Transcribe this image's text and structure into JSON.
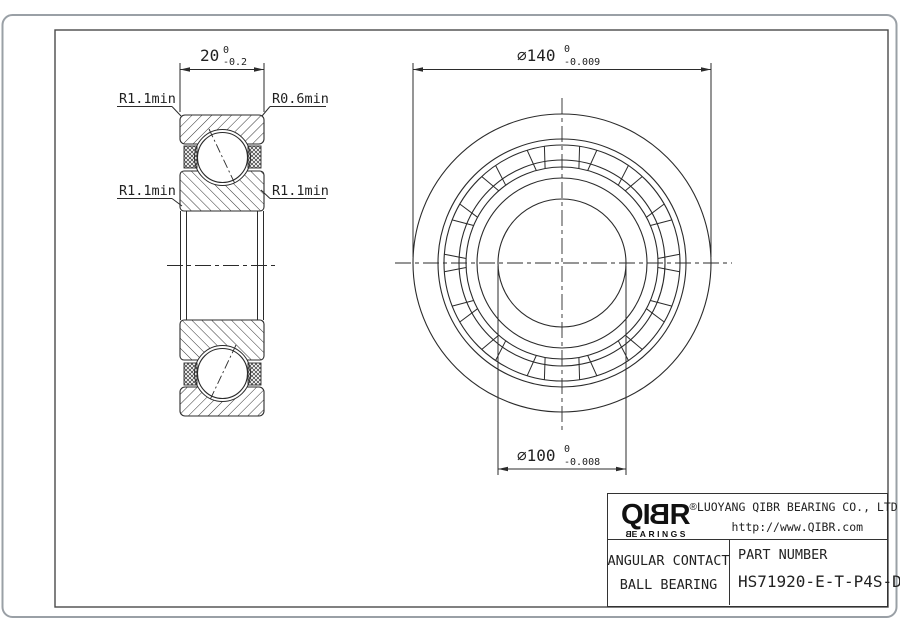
{
  "colors": {
    "line": "#2b2b2b",
    "frame": "#4a4a4a",
    "page_border": "#9aa0a6",
    "title_lines": "#333333"
  },
  "left_view": {
    "width_dim": {
      "value": "20",
      "tol_upper": "0",
      "tol_lower": "-0.2"
    },
    "labels": {
      "top_left": "R1.1min",
      "top_right": "R0.6min",
      "bottom_left": "R1.1min",
      "bottom_right": "R1.1min"
    }
  },
  "front_view": {
    "od_dim": {
      "symbol": "⌀",
      "value": "140",
      "tol_upper": "0",
      "tol_lower": "-0.009"
    },
    "bore_dim": {
      "symbol": "⌀",
      "value": "100",
      "tol_upper": "0",
      "tol_lower": "-0.008"
    }
  },
  "title_block": {
    "logo": {
      "l1": "Q",
      "l2": "I",
      "l3": "B",
      "l4": "R",
      "reg": "®",
      "word_first": "B",
      "word_rest": "EARINGS"
    },
    "company": "LUOYANG QIBR BEARING CO., LTD",
    "website": "http://www.QIBR.com",
    "product_line1": "ANGULAR CONTACT",
    "product_line2": "BALL BEARING",
    "part_number_label": "PART NUMBER",
    "part_number": "HS71920-E-T-P4S-DF"
  }
}
